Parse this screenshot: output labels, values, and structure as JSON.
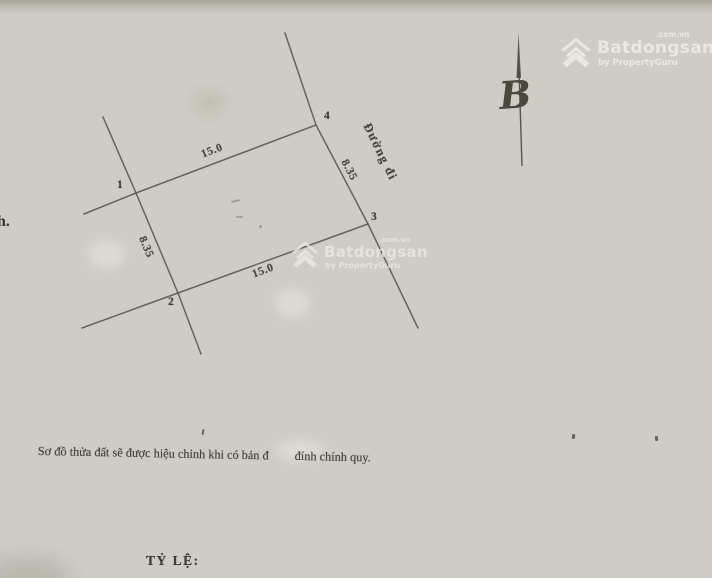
{
  "watermarks": {
    "top_right": {
      "brand": "Batdongsan",
      "tld": ".com.vn",
      "byline": "by PropertyGuru"
    },
    "center": {
      "brand": "Batdongsan",
      "tld": ".com.vn",
      "byline": "by PropertyGuru"
    }
  },
  "compass": {
    "label": "B"
  },
  "survey": {
    "road_label": "Đường đi",
    "corners": [
      {
        "label": "1"
      },
      {
        "label": "2"
      },
      {
        "label": "3"
      },
      {
        "label": "4"
      }
    ],
    "dims": {
      "top": "15.0",
      "bottom": "15.0",
      "left": "8.35",
      "right": "8.35"
    }
  },
  "margin_note": "h.",
  "footer": {
    "note_before": "Sơ đồ thửa đất sẽ được hiệu chỉnh khi có bản đ",
    "note_after": "đính chính quy.",
    "scale_label": "TỶ LỆ:"
  },
  "colors": {
    "paper": "#cfccc5",
    "ink": "#5d5a52",
    "watermark": "#edeae3"
  }
}
